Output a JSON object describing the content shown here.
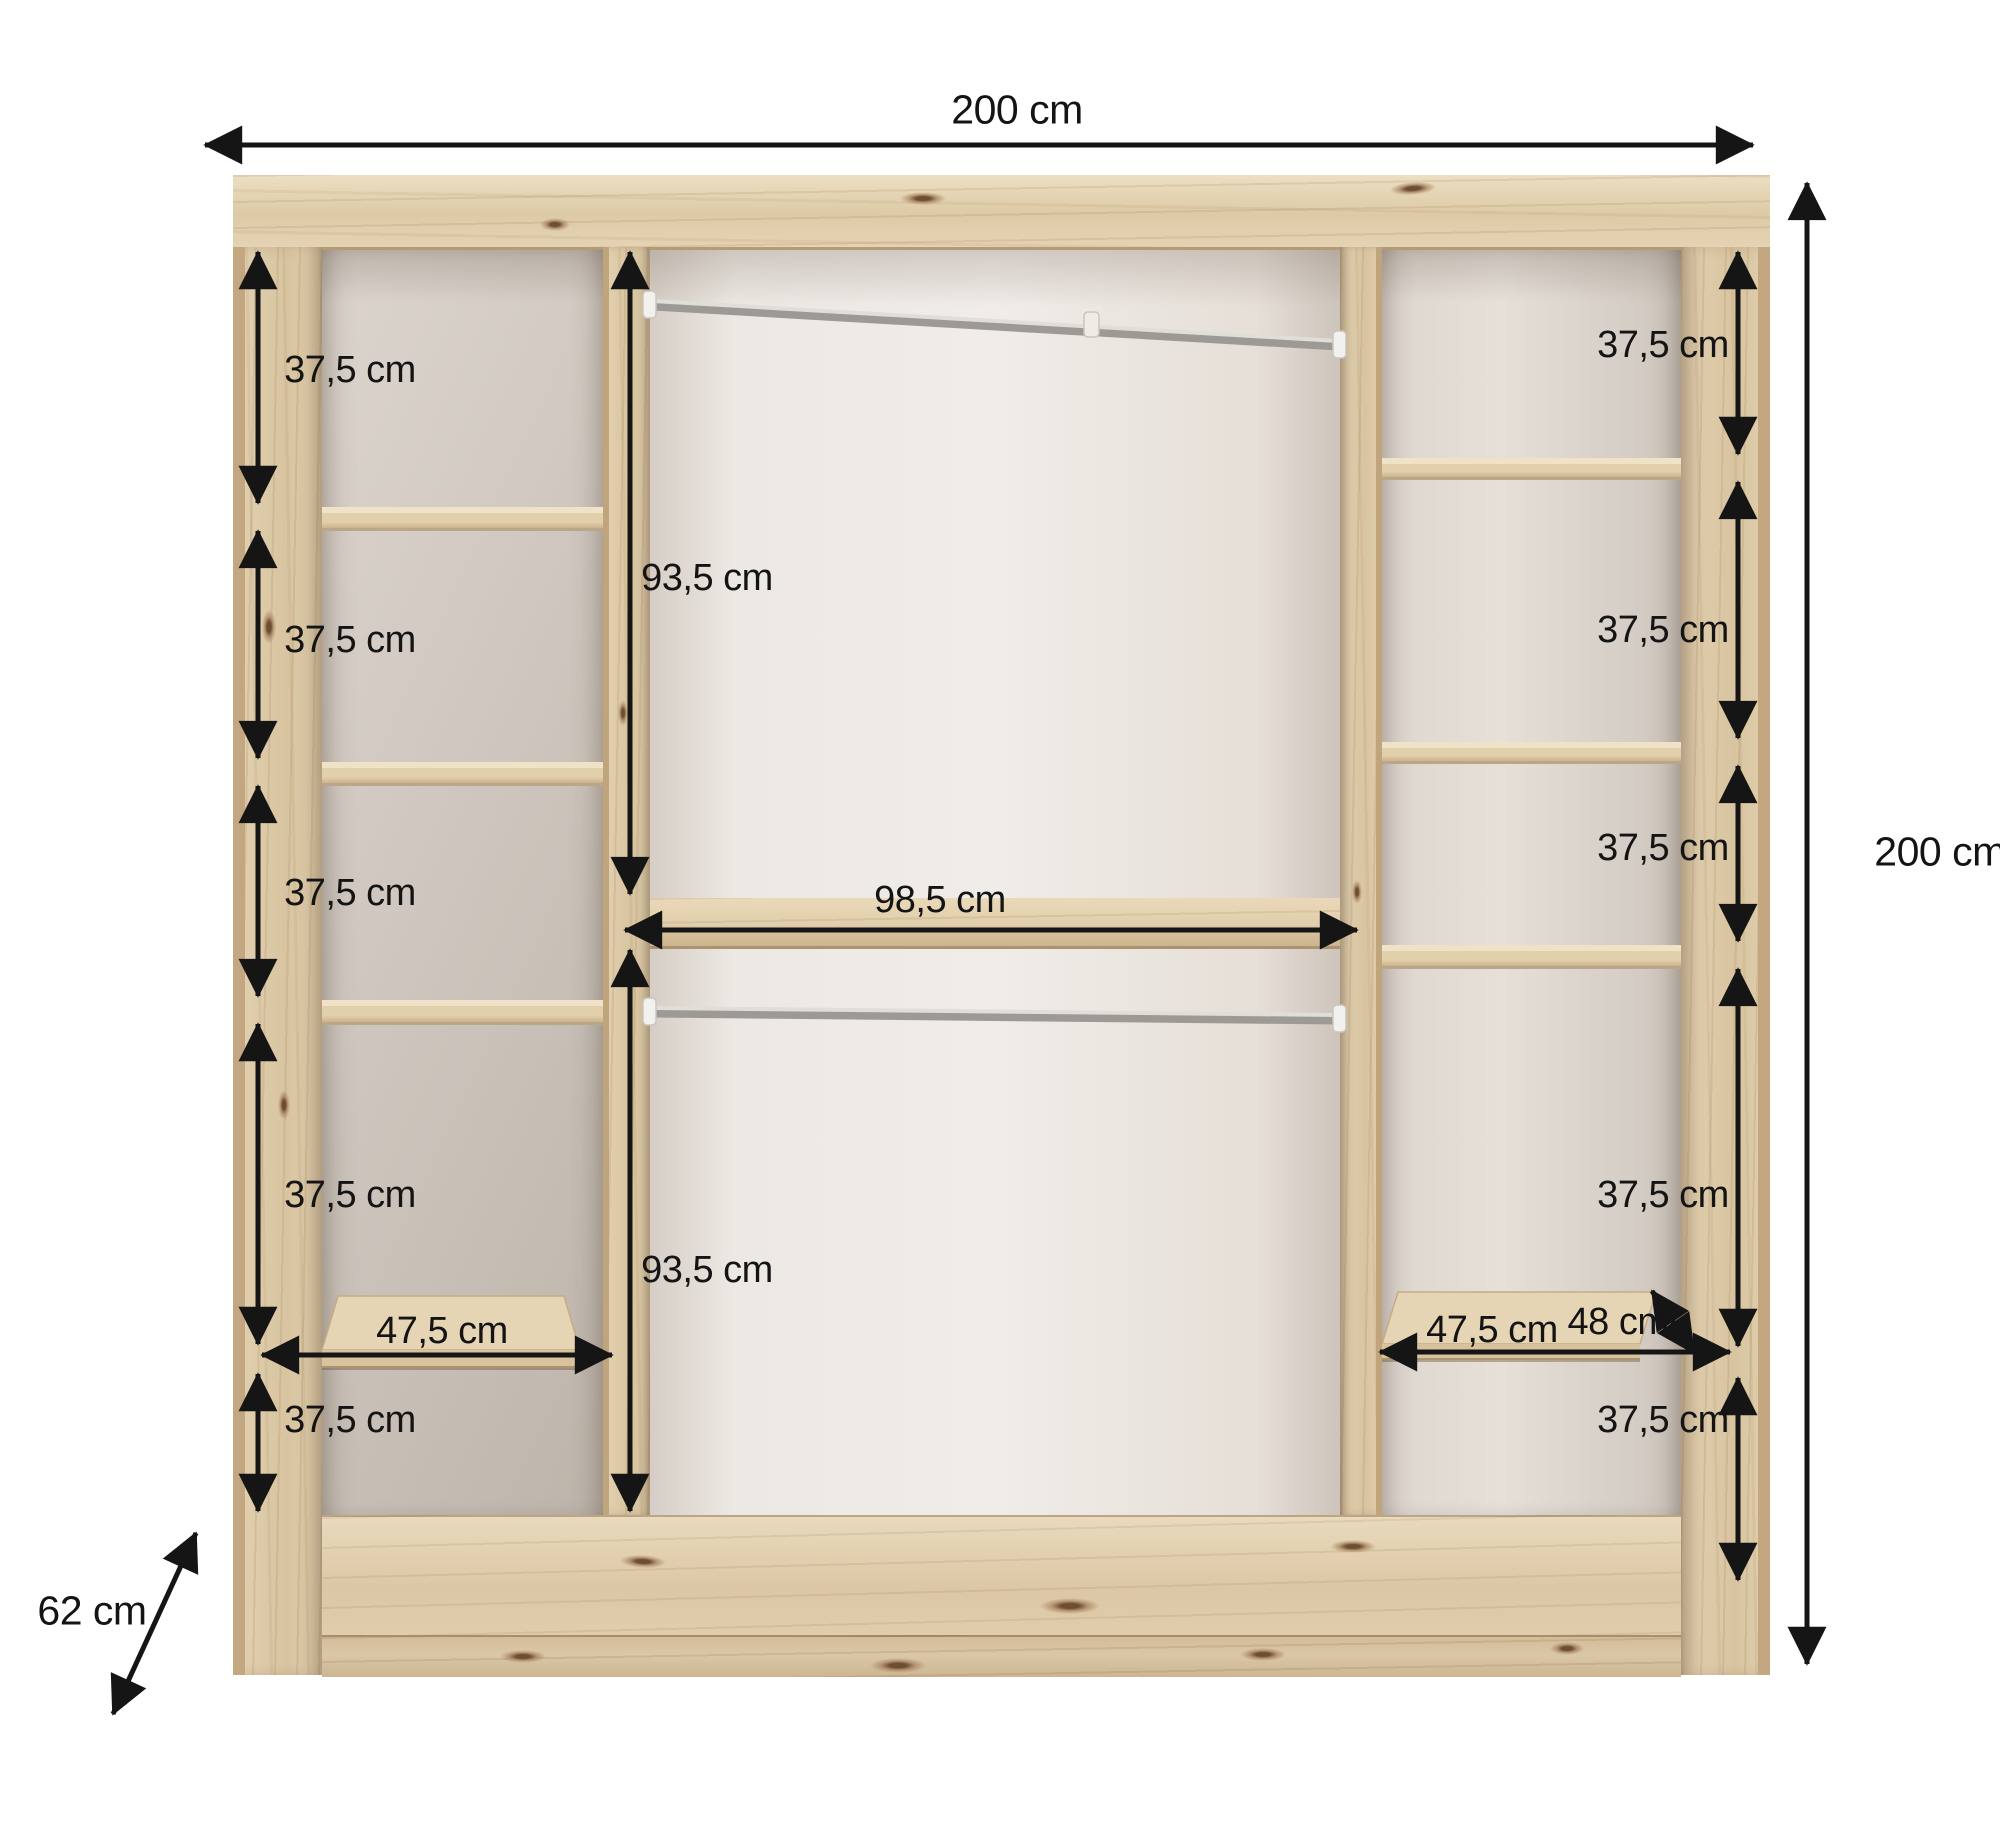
{
  "diagram": {
    "title": "Wardrobe interior dimension diagram",
    "unit": "cm",
    "overall": {
      "width": "200 cm",
      "height": "200 cm",
      "depth": "62 cm"
    },
    "center_section": {
      "clear_width": "98,5 cm",
      "upper_compartment_height": "93,5 cm",
      "lower_compartment_height": "93,5 cm"
    },
    "left_column": {
      "compartment_heights": [
        "37,5 cm",
        "37,5 cm",
        "37,5 cm",
        "37,5 cm",
        "37,5 cm"
      ],
      "shelf_width": "47,5 cm"
    },
    "right_column": {
      "compartment_heights": [
        "37,5 cm",
        "37,5 cm",
        "37,5 cm",
        "37,5 cm",
        "37,5 cm"
      ],
      "shelf_width": "47,5 cm",
      "shelf_depth": "48 cm"
    },
    "colors": {
      "background": "#ffffff",
      "wood_light": "#e7d9bc",
      "wood_mid": "#dcc8a6",
      "wood_dark": "#bba081",
      "back_panel": "#e7e0d9",
      "dimension_lines": "#151515",
      "rail_metal": "#b3b0ab"
    }
  }
}
